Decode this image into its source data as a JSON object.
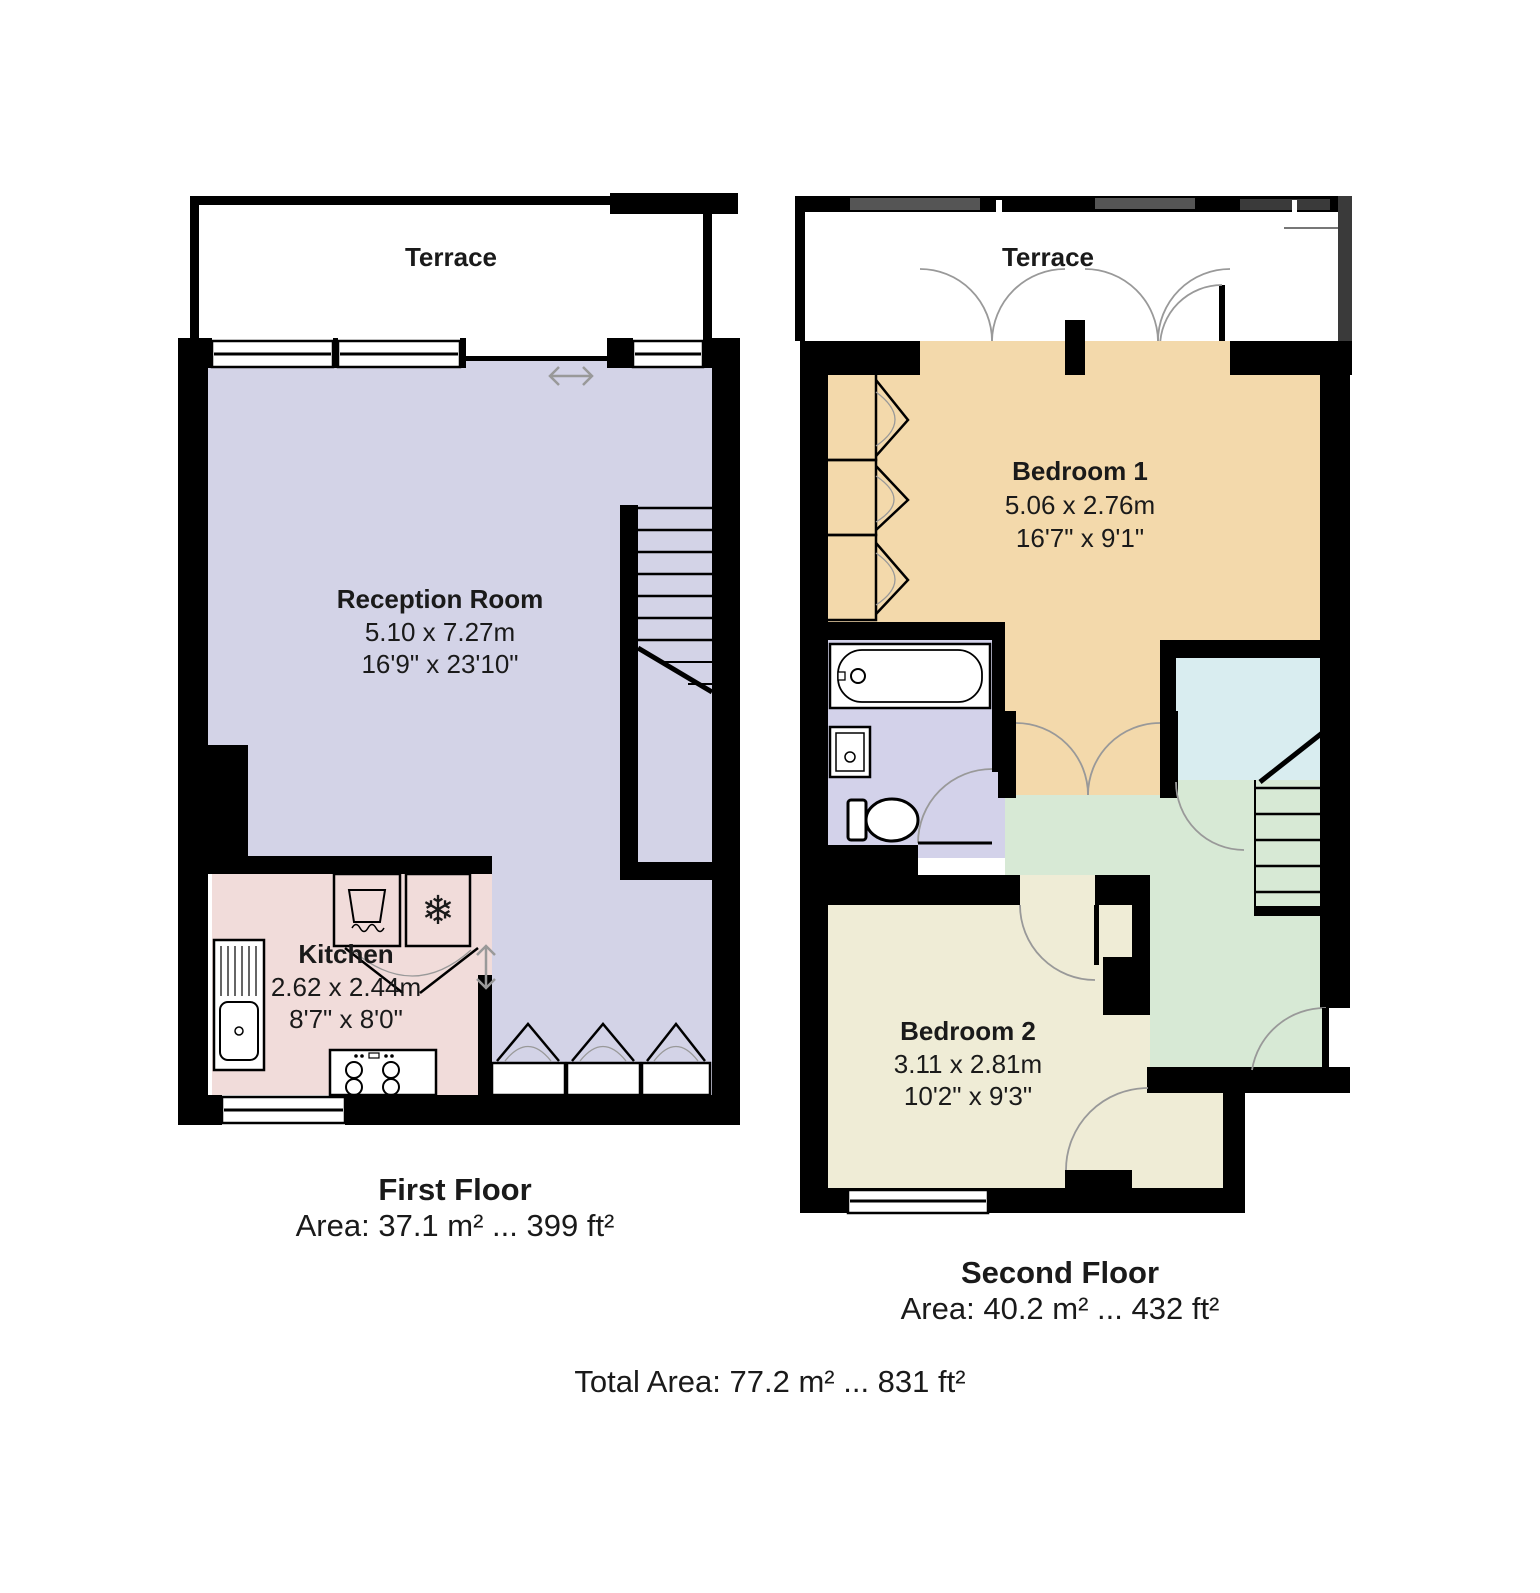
{
  "title": "Floor plan",
  "colors": {
    "wall": "#000000",
    "party_wall": "#3a3a3a",
    "party_wall_light": "#555555",
    "reception": "#d3d3e7",
    "kitchen": "#f1dcda",
    "bedroom1": "#f3d9ab",
    "bedroom2": "#efecd6",
    "landing": "#d7e9d5",
    "bathroom": "#d3d2ea",
    "stair_room": "#d9edf0",
    "door_arc": "#999999",
    "window_fill": "#ffffff",
    "fixture_fill": "#ffffff"
  },
  "icons": {
    "freezer": "❄"
  },
  "floors": [
    {
      "caption": "First Floor",
      "area_label": "Area: 37.1 m² ... 399 ft²",
      "terrace_label": "Terrace",
      "rooms": [
        {
          "name": "Reception Room",
          "dims_m": "5.10 x 7.27m",
          "dims_ft": "16'9\" x 23'10\""
        },
        {
          "name": "Kitchen",
          "dims_m": "2.62 x 2.44m",
          "dims_ft": "8'7\" x 8'0\""
        }
      ]
    },
    {
      "caption": "Second Floor",
      "area_label": "Area: 40.2 m² ... 432 ft²",
      "terrace_label": "Terrace",
      "rooms": [
        {
          "name": "Bedroom 1",
          "dims_m": "5.06 x 2.76m",
          "dims_ft": "16'7\" x 9'1\""
        },
        {
          "name": "Bedroom 2",
          "dims_m": "3.11 x 2.81m",
          "dims_ft": "10'2\" x 9'3\""
        }
      ]
    }
  ],
  "total_area_label": "Total Area: 77.2 m² ... 831 ft²"
}
